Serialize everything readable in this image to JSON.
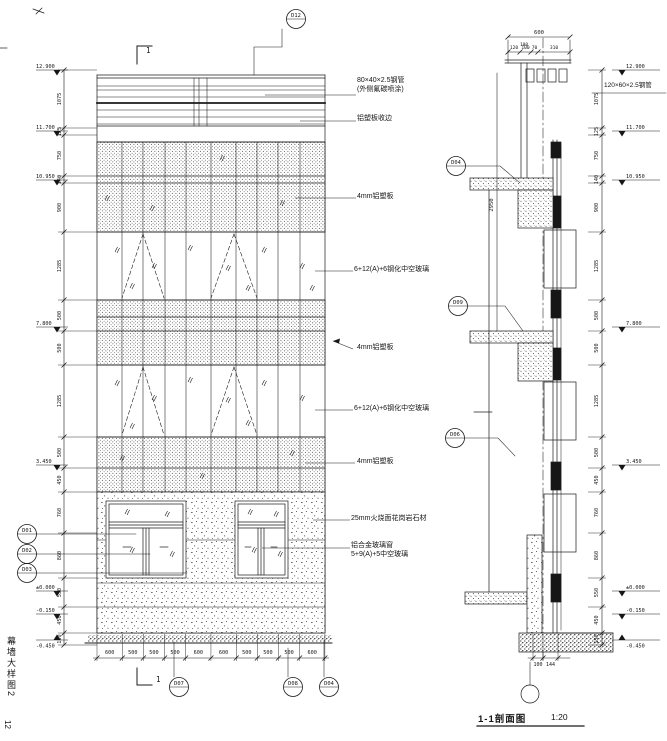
{
  "sheet": {
    "title_vertical": "幕墙大样图2",
    "page_number": "12",
    "line_color": "#1b1b1b"
  },
  "elevation": {
    "section_cut_label_top": "1",
    "section_cut_label_bottom": "1",
    "top_detail_bubble": "D12",
    "bottom_detail_bubbles": [
      "D07",
      "D08",
      "D04"
    ],
    "left_detail_bubbles": [
      "D01",
      "D02",
      "D03"
    ],
    "annotations": [
      {
        "line1": "80×40×2.5钢管",
        "line2": "(外侧氟碳喷涂)"
      },
      {
        "line1": "铝塑板收边"
      },
      {
        "line1": "4mm铝塑板"
      },
      {
        "line1": "6+12(A)+6钢化中空玻璃"
      },
      {
        "line1": "4mm铝塑板"
      },
      {
        "line1": "6+12(A)+6钢化中空玻璃"
      },
      {
        "line1": "4mm铝塑板"
      },
      {
        "line1": "25mm火烧面花岗岩石材"
      },
      {
        "line1": "铝合金玻璃窗",
        "line2": "5+9(A)+5中空玻璃"
      }
    ],
    "left_dims": [
      "1075",
      "125",
      "750",
      "140",
      "900",
      "1285",
      "500",
      "500",
      "1285",
      "500",
      "450",
      "760",
      "860",
      "550",
      "450",
      "150"
    ],
    "left_levels": [
      "12.900",
      "11.700",
      "10.950",
      "7.800",
      "3.450",
      "±0.000",
      "-0.150",
      "-0.450"
    ],
    "bottom_dims": [
      "600",
      "500",
      "500",
      "500",
      "600",
      "600",
      "500",
      "500",
      "500",
      "600"
    ]
  },
  "section": {
    "title": "1-1剖面图",
    "scale": "1:20",
    "steel_tube_note": "120×60×2.5钢管",
    "overall_top_dim": "600",
    "top_sub_dim": "100",
    "top_dims": [
      "120",
      "100",
      "70",
      "310"
    ],
    "height_dim": "2950",
    "bottom_dims": [
      "100",
      "144"
    ],
    "right_dims": [
      "1075",
      "125",
      "750",
      "140",
      "900",
      "1285",
      "500",
      "500",
      "1285",
      "500",
      "450",
      "760",
      "860",
      "550",
      "450",
      "150"
    ],
    "right_levels": [
      "12.900",
      "11.700",
      "10.950",
      "7.800",
      "3.450",
      "±0.000",
      "-0.150",
      "-0.450"
    ],
    "detail_bubbles": [
      "D04",
      "D09",
      "D06"
    ]
  }
}
